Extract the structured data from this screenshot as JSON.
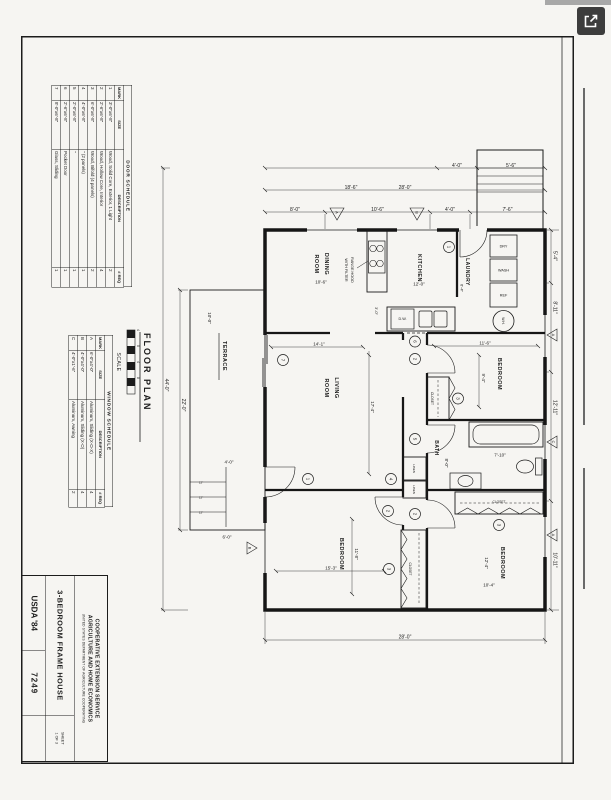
{
  "viewer": {
    "open_button_icon": "open-in-new"
  },
  "sheet": {
    "title_block": {
      "org1": "COOPERATIVE EXTENSION SERVICE",
      "org2": "AGRICULTURE AND HOME ECONOMICS",
      "org_sub": "UNITED STATES DEPARTMENT OF AGRICULTURE COOPERATING",
      "title": "3-BEDROOM FRAME HOUSE",
      "sheet_label": "SHEET",
      "sheet_value": "1 OF 3",
      "agency": "USDA '84",
      "number": "7249"
    },
    "door_schedule": {
      "title": "DOOR SCHEDULE",
      "headers": [
        "MARK",
        "SIZE",
        "DESCRIPTION",
        "# REQ"
      ],
      "rows": [
        [
          "1",
          "3'-0\"x6'-8\"",
          "Wood, Solid Core, Exterior, 1 Light",
          "2"
        ],
        [
          "2",
          "2'-6\"x6'-8\"",
          "Wood, Hollow Core, Interior",
          "4"
        ],
        [
          "3",
          "6'-0\"x6'-8\"",
          "Wood, Bifold (4 panels)",
          "2"
        ],
        [
          "4",
          "4'-0\"x6'-8\"",
          "\"    (2 panels)",
          "1"
        ],
        [
          "5",
          "2'-0\"x6'-8\"",
          "\"",
          "1"
        ],
        [
          "6",
          "2'-6\"x6'-8\"",
          "Pocket Door",
          "1"
        ],
        [
          "7",
          "8'-0\"x6'-8\"",
          "Glass, Sliding",
          "1"
        ]
      ]
    },
    "window_schedule": {
      "title": "WINDOW SCHEDULE",
      "headers": [
        "MARK",
        "SIZE",
        "DESCRIPTION",
        "# REQ"
      ],
      "rows": [
        [
          "A",
          "6'-0\"x4'-0\"",
          "Aluminum, Sliding (X-O-X)",
          "4"
        ],
        [
          "B",
          "4'-0\"x4'-0\"",
          "Aluminum, Sliding (X-O)",
          "4"
        ],
        [
          "C",
          "4'-0\"x1'-6\"",
          "Aluminum, Awning",
          "2"
        ]
      ]
    },
    "plan": {
      "title": "FLOOR PLAN",
      "scale_label": "SCALE",
      "scale_ticks": [
        "4",
        "0",
        "4",
        "8"
      ],
      "rooms": {
        "living1": "LIVING",
        "living2": "ROOM",
        "dining1": "DINING",
        "dining2": "ROOM",
        "kitchen": "KITCHEN",
        "laundry": "LAUNDRY",
        "bath": "BATH",
        "bedroom": "BEDROOM",
        "terrace": "TERRACE",
        "closet": "CLOSET",
        "linen": "LINEN"
      },
      "fixtures": {
        "range1": "RANGE HOOD",
        "range2": "WITH FILTER",
        "dw": "D.W.",
        "ref": "REF",
        "wash": "WASH",
        "dry": "DRY",
        "wh": "W.H."
      },
      "dims": {
        "d3_0": "3'-0\"",
        "d4_0": "4'-0\"",
        "d5_4": "5'-4\"",
        "d5_6": "5'-6\"",
        "d6_0": "6'-0\"",
        "d6_4": "6'-4\"",
        "d7_6": "7'-6\"",
        "d7_10": "7'-10\"",
        "d8_0": "8'-0\"",
        "d8_11": "8'-11\"",
        "d9_4": "9'-4\"",
        "d10_0": "10'-0\"",
        "d10_4": "10'-4\"",
        "d10_6": "10'-6\"",
        "d10_11": "10'-11\"",
        "d11_6": "11'-6\"",
        "d11_8": "11'-8\"",
        "d12_0": "12'-0\"",
        "d12_4": "12'-4\"",
        "d12_11": "12'-11\"",
        "d12in": "12\"",
        "d14_1": "14'-1\"",
        "d15_3": "15'-3\"",
        "d17_4": "17'-4\"",
        "d18_6": "18'-6\"",
        "d22_0": "22'-0\"",
        "d28_0": "28'-0\"",
        "d44_0": "44'-0\""
      },
      "door_marks": {
        "m1": "1",
        "m2": "2",
        "m3": "3",
        "m4": "4",
        "m5": "5",
        "m6": "6",
        "m7": "7"
      },
      "window_marks": {
        "a": "A",
        "b": "B",
        "c": "C"
      }
    }
  }
}
